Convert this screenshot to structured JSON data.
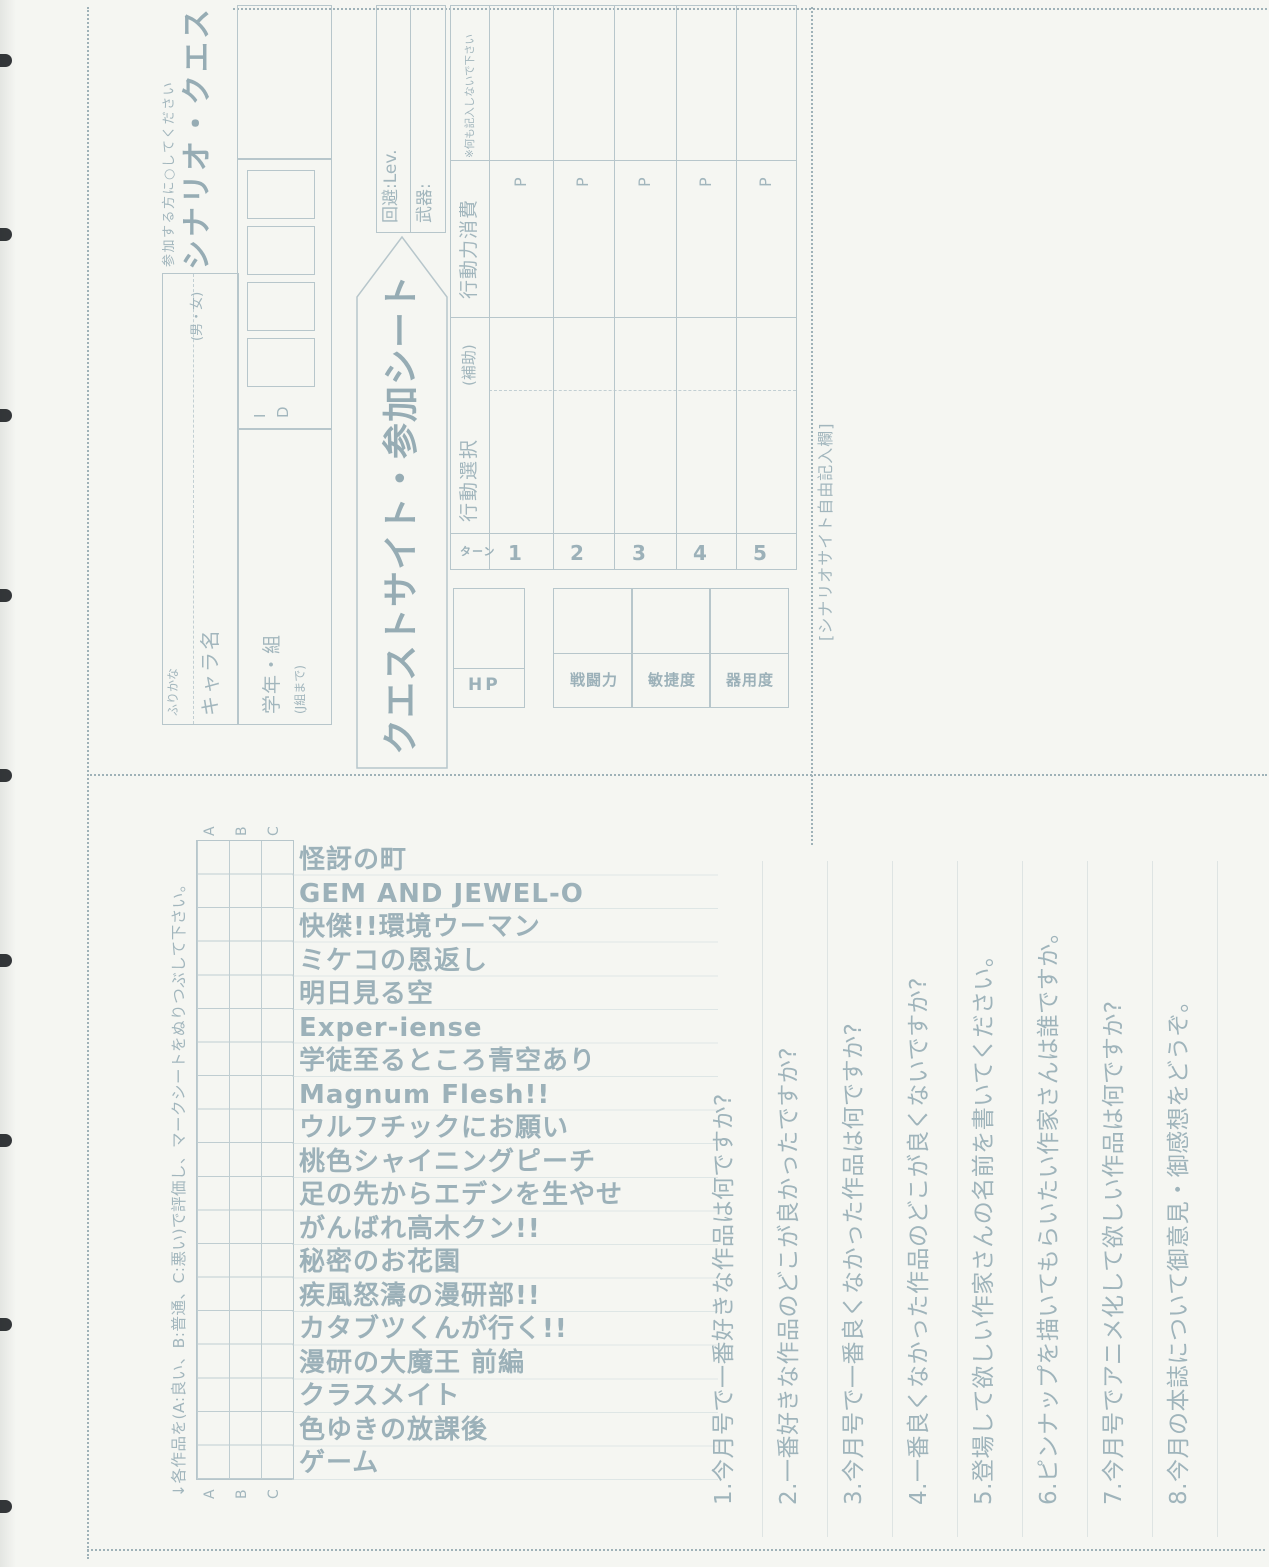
{
  "colors": {
    "paper": "#f5f6f2",
    "ink": "#a2b6bd",
    "ink_strong": "#96acb4",
    "grid_line": "#b7c6cb",
    "hole": "#232629"
  },
  "quest_sheet": {
    "join_note": "参加する方に○してください",
    "title": "シナリオ・クエスト",
    "name_row": {
      "furigana_label": "ふりかな",
      "name_label": "キャラ名",
      "gender_label": "(男・女)"
    },
    "grade_row": {
      "grade_label": "学年・組",
      "grade_note": "(J組まで)",
      "id_label": "ID"
    },
    "banner": "クエストサイト・参加シート",
    "level_box": {
      "evade_label": "回避:Lev.",
      "weapon_label": "武器:"
    },
    "hp_label": "HP",
    "stats": [
      "戦闘力",
      "敏捷度",
      "器用度"
    ],
    "turn_table": {
      "headers": {
        "turn": "ターン",
        "action": "行動選択",
        "support": "(補助)",
        "cost": "行動力消費",
        "note": "※何も記入しないで下さい"
      },
      "rows": [
        {
          "turn": "1",
          "unit": "P"
        },
        {
          "turn": "2",
          "unit": "P"
        },
        {
          "turn": "3",
          "unit": "P"
        },
        {
          "turn": "4",
          "unit": "P"
        },
        {
          "turn": "5",
          "unit": "P"
        }
      ]
    },
    "free_entry_label": "[シナリオサイト自由記入欄]"
  },
  "survey": {
    "instruction": "↓各作品を(A:良い、B:普通、C:悪い)で評価し、マークシートをぬりつぶして下さい。",
    "grade_labels": [
      "A",
      "B",
      "C"
    ],
    "titles": [
      "怪訝の町",
      "GEM AND JEWEL-O",
      "快傑!!環境ウーマン",
      "ミケコの恩返し",
      "明日見る空",
      "Exper-iense",
      "学徒至るところ青空あり",
      "Magnum Flesh!!",
      "ウルフチックにお願い",
      "桃色シャイニングピーチ",
      "足の先からエデンを生やせ",
      "がんばれ高木クン!!",
      "秘密のお花園",
      "疾風怒濤の漫研部!!",
      "カタブツくんが行く!!",
      "漫研の大魔王 前編",
      "クラスメイト",
      "色ゆきの放課後",
      "ゲーム"
    ],
    "questions": [
      "1.今月号で一番好きな作品は何ですか?",
      "2.一番好きな作品のどこが良かったですか?",
      "3.今月号で一番良くなかった作品は何ですか?",
      "4.一番良くなかった作品のどこが良くないですか?",
      "5.登場して欲しい作家さんの名前を書いてください。",
      "6.ピンナップを描いてもらいたい作家さんは誰ですか。",
      "7.今月号でアニメ化して欲しい作品は何ですか?",
      "8.今月の本誌について御意見・御感想をどうぞ。"
    ]
  }
}
